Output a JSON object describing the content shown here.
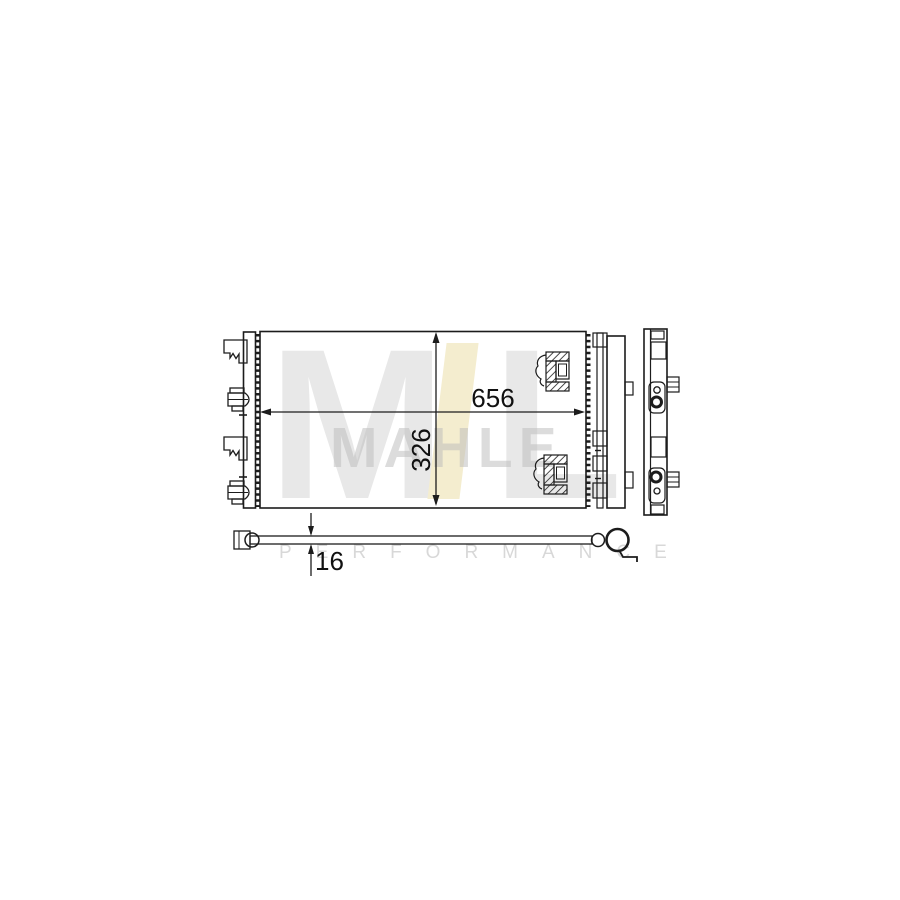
{
  "diagram": {
    "dimensions": {
      "width_mm": "656",
      "height_mm": "326",
      "depth_mm": "16"
    },
    "watermark": {
      "logo_letter_m": "M",
      "logo_letter_l": "L",
      "brand_text": "MAHLE",
      "subtitle_text": "PERFORMANCE",
      "logo_gray": "#e8e8e8",
      "logo_accent": "#f4edcf",
      "subtitle_gray": "#d8d8d8"
    },
    "line_color": "#1c1c1c",
    "views": {
      "front": "front-view",
      "side": "side-view",
      "top": "top-view"
    }
  }
}
